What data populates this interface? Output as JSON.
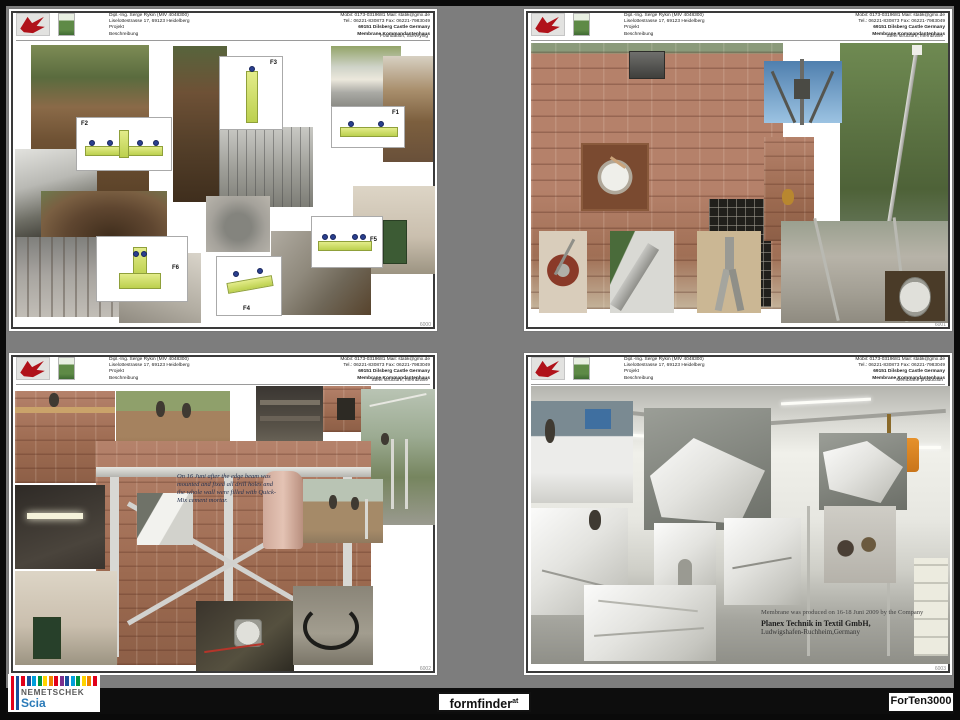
{
  "window": {
    "background": "#0a0a0a",
    "slide_background": "#7d7d7d"
  },
  "header_common": {
    "left_lines": [
      "Dipl.-Ing. Serge Rykin (MIV 4048300)",
      "Liselottestrasse 17, 69123 Heidelberg",
      "Projekt",
      "Beschreibung"
    ],
    "right_lines": [
      "Mobil: 0173-0319681  Mail: statik@gmx.de",
      "Tel.: 06221-830873  Fax: 06221-7983049",
      "69151 Dilsberg Castle Germany",
      "Membrane Kommandantenhaus"
    ]
  },
  "sheets": [
    {
      "title": "Foundation, Surveying",
      "sheet_no": "6000",
      "cad_labels": [
        "F1",
        "F2",
        "F3",
        "F4",
        "F5",
        "F6"
      ]
    },
    {
      "title": "Steel structure, membrane",
      "sheet_no": "6001"
    },
    {
      "title": "Steel structure, membrane",
      "sheet_no": "6002",
      "note": "On 16 Juni after the edge beam was mounted and fixed all drill holes and the whole wall were filled with Quick-Mix cement mortar."
    },
    {
      "title": "Membrane production",
      "sheet_no": "6003",
      "note_lines": [
        "Membrane was produced on 16-18 Juni 2009 by the Company",
        "Planex Technik in Textil GmbH,",
        "Ludwigshafen-Ruchheim,Germany"
      ]
    }
  ],
  "footer": {
    "nemetschek": {
      "brand": "NEMETSCHEK",
      "product": "Scia",
      "bar_colors": [
        "#e2001a",
        "#1a4f9c",
        "#00a0dc",
        "#009540",
        "#ffd400",
        "#f08300",
        "#e2001a",
        "#7a2e8d",
        "#1a4f9c",
        "#00a0dc",
        "#009540",
        "#ffd400",
        "#f08300",
        "#e2001a"
      ]
    },
    "formfinder": {
      "label": "formfinder",
      "sup": "at"
    },
    "forten": {
      "label": "ForTen3000"
    }
  }
}
